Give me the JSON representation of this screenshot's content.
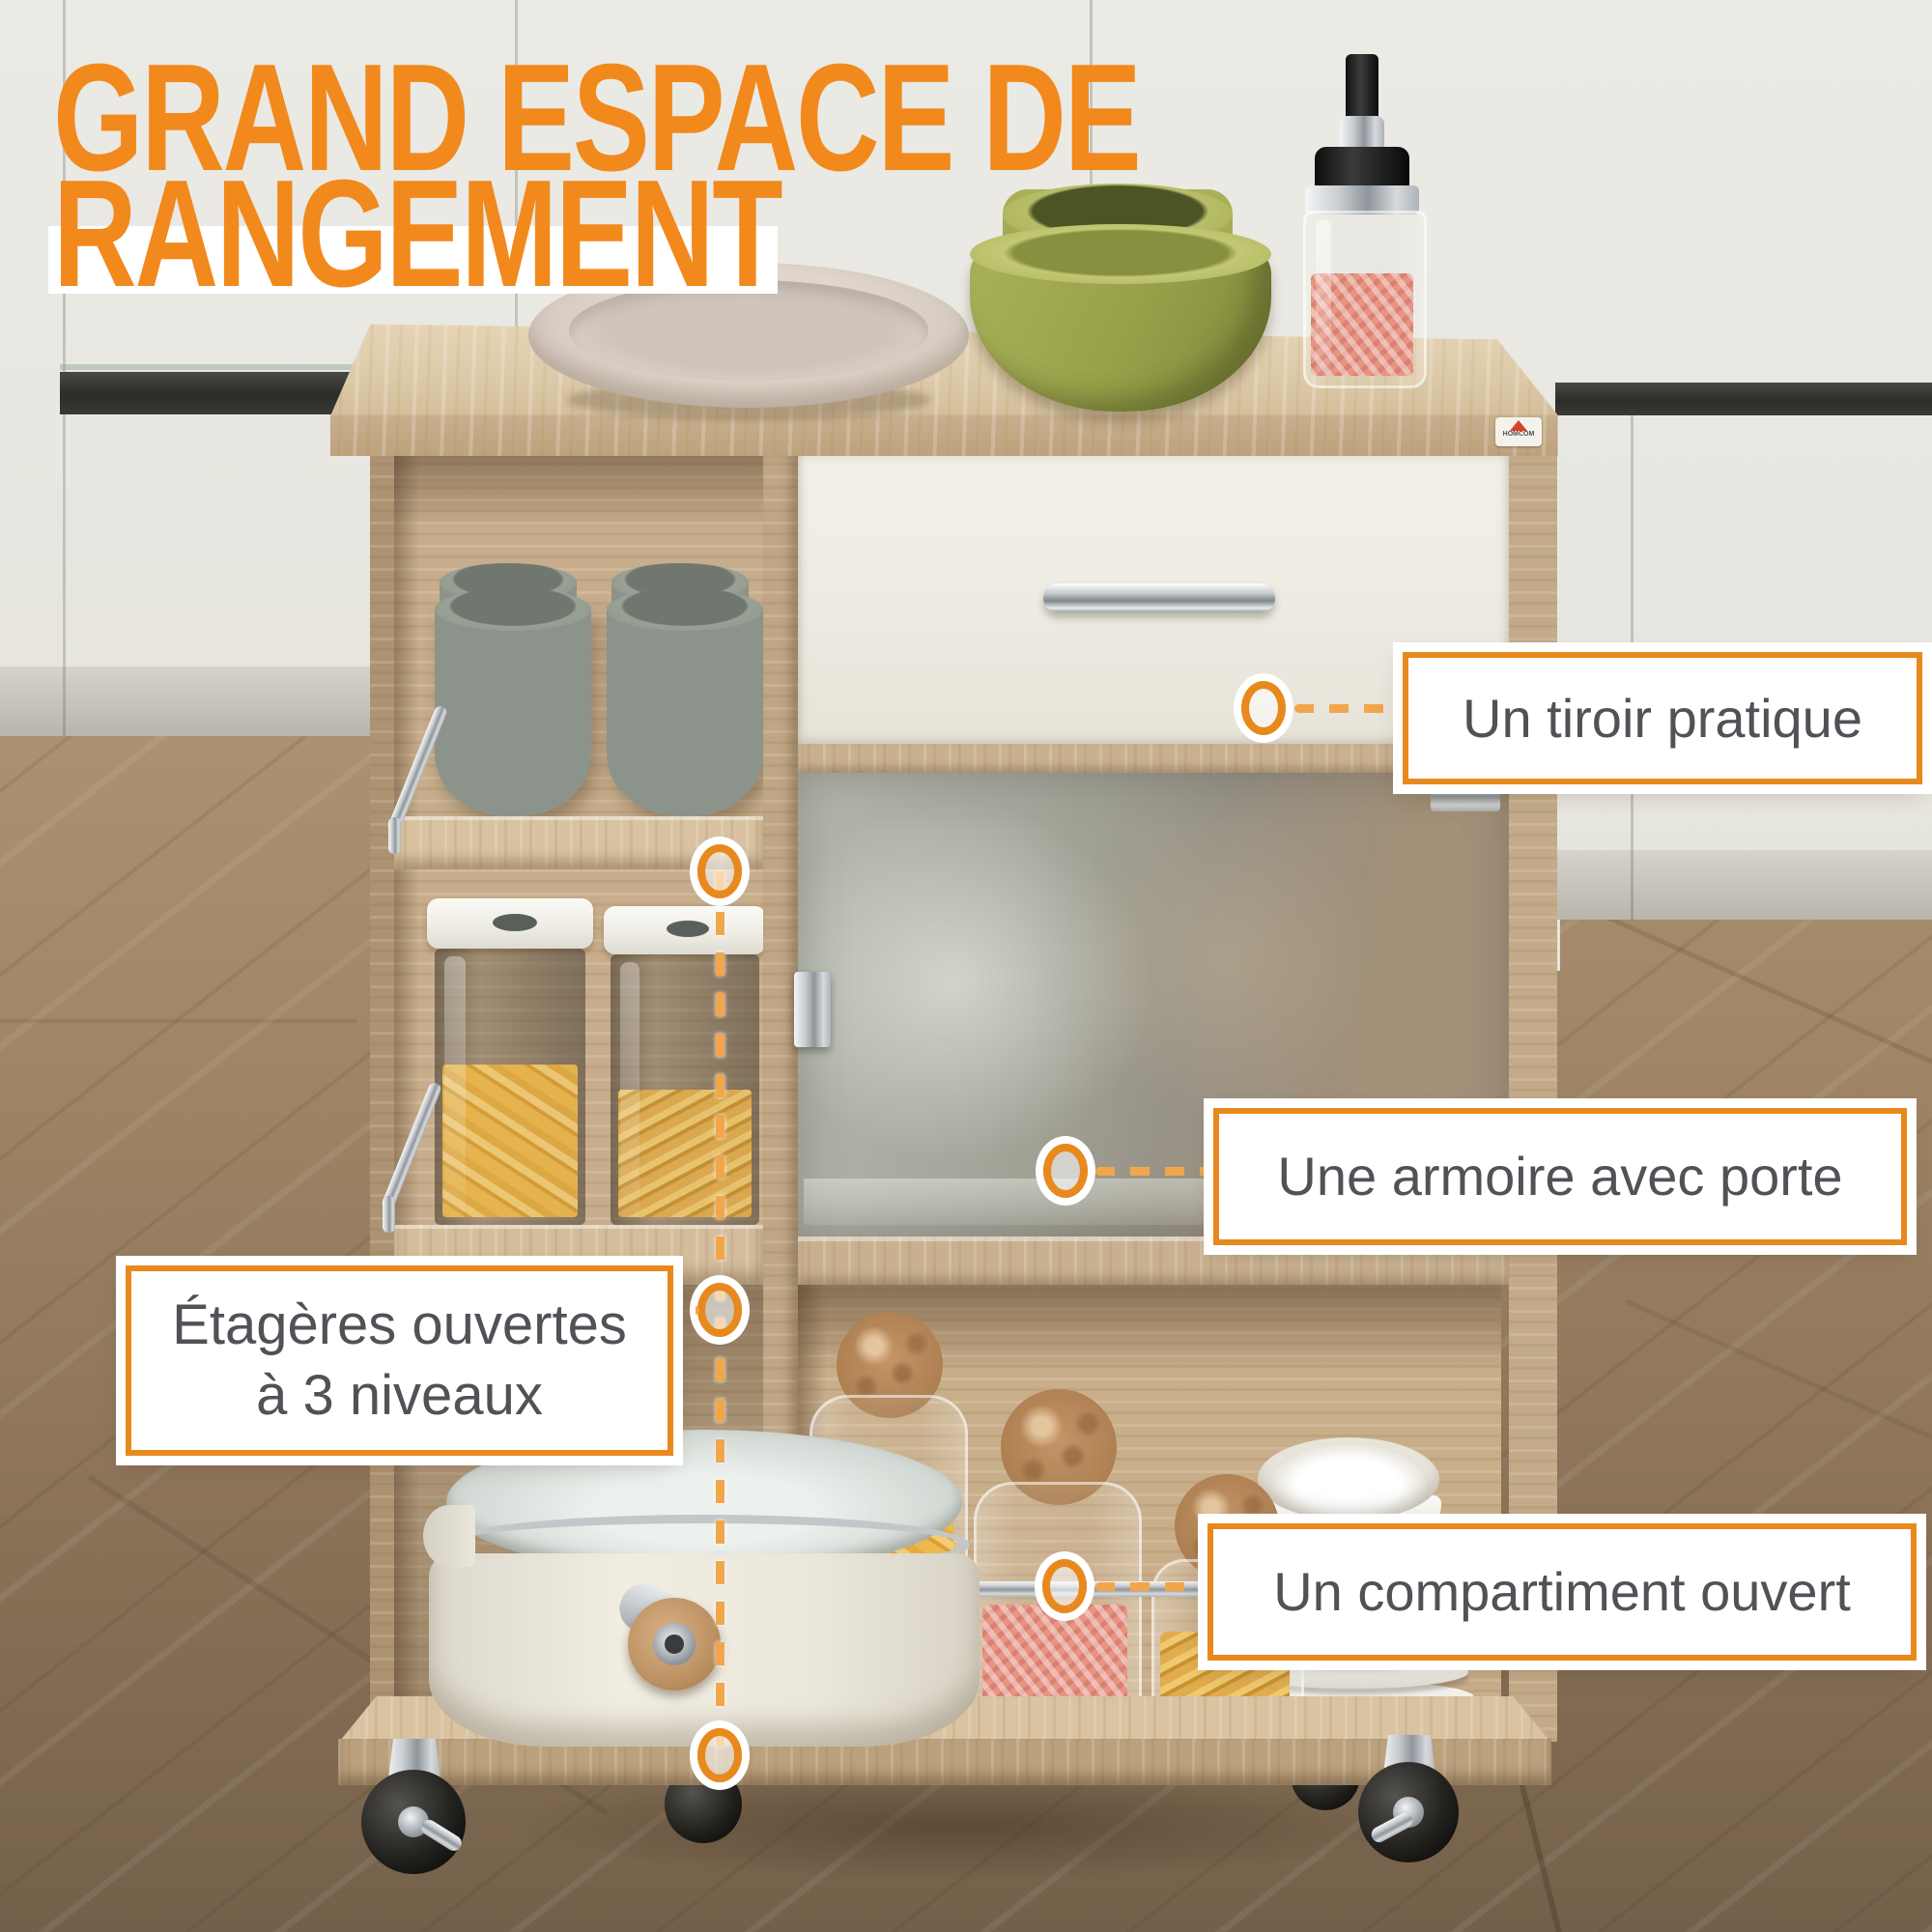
{
  "title": {
    "line1": "GRAND ESPACE DE",
    "line2": "RANGEMENT",
    "color": "#F2891D",
    "highlight_bg": "#FFFFFF"
  },
  "brand": {
    "name": "HOMCOM",
    "icon_color": "#D8402A"
  },
  "callouts": {
    "accent_border": "#E8891E",
    "dash_color": "#F2A64B",
    "text_color": "#4F5256",
    "box_bg": "#FFFFFF",
    "tiroir": {
      "label": "Un tiroir pratique"
    },
    "armoire": {
      "label": "Une armoire avec porte"
    },
    "etageres": {
      "line1": "Étagères ouvertes",
      "line2": "à 3 niveaux"
    },
    "compartiment": {
      "label": "Un compartiment ouvert"
    }
  },
  "palette": {
    "wood_light": "#DCC8A6",
    "wood_mid": "#C9B190",
    "wood_dark": "#A98E6C",
    "drawer_front": "#F0EEE5",
    "glass_door": "#A9ACA0",
    "wall": "#E9E8E3",
    "floor": "#9A8165",
    "cup_gray": "#8C938A",
    "pasta_amber": "#EDB84C",
    "pink_salt": "#E79483"
  }
}
